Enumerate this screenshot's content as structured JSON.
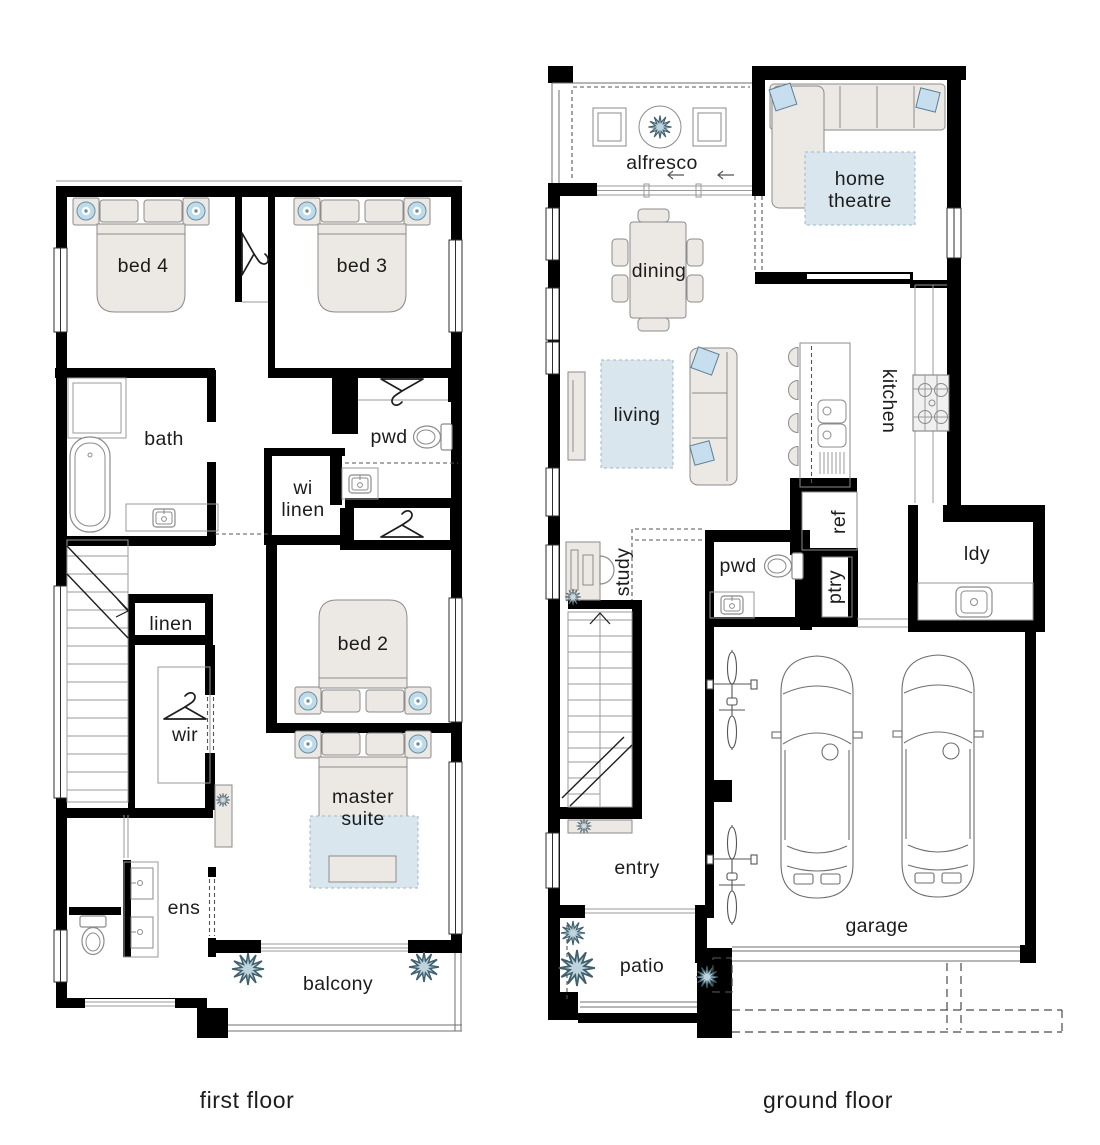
{
  "first_floor": {
    "caption": "first floor",
    "rooms": {
      "bed4": "bed 4",
      "bed3": "bed 3",
      "bath": "bath",
      "pwd": "pwd",
      "wi_linen_line1": "wi",
      "wi_linen_line2": "linen",
      "linen": "linen",
      "wir": "wir",
      "bed2": "bed 2",
      "master_line1": "master",
      "master_line2": "suite",
      "ens": "ens",
      "balcony": "balcony"
    }
  },
  "ground_floor": {
    "caption": "ground floor",
    "rooms": {
      "alfresco": "alfresco",
      "home_theatre_line1": "home",
      "home_theatre_line2": "theatre",
      "dining": "dining",
      "living": "living",
      "kitchen": "kitchen",
      "ref": "ref",
      "ptry": "ptry",
      "study": "study",
      "pwd": "pwd",
      "ldy": "ldy",
      "entry": "entry",
      "garage": "garage",
      "patio": "patio"
    }
  },
  "colors": {
    "background": "#ffffff",
    "wall": "#000000",
    "furniture_fill": "#ece9e4",
    "rug_blue": "#d9e6ee",
    "cushion_blue": "#c6deee",
    "lamp_blue": "#bedbeb",
    "plant_blue": "#bdd3de",
    "text": "#1c1c1c"
  }
}
